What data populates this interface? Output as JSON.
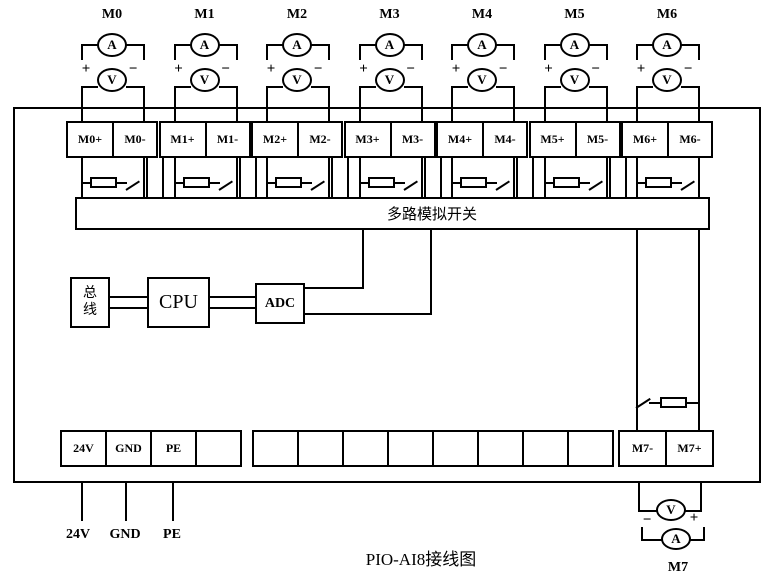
{
  "title": "PIO-AI8接线图",
  "mux_label": "多路模拟开关",
  "bus_label": "总线",
  "cpu_label": "CPU",
  "adc_label": "ADC",
  "meters": {
    "ammeter": "A",
    "voltmeter": "V",
    "plus": "+",
    "minus": "−"
  },
  "channels": [
    {
      "label": "M0",
      "plus_terminal": "M0+",
      "minus_terminal": "M0-"
    },
    {
      "label": "M1",
      "plus_terminal": "M1+",
      "minus_terminal": "M1-"
    },
    {
      "label": "M2",
      "plus_terminal": "M2+",
      "minus_terminal": "M2-"
    },
    {
      "label": "M3",
      "plus_terminal": "M3+",
      "minus_terminal": "M3-"
    },
    {
      "label": "M4",
      "plus_terminal": "M4+",
      "minus_terminal": "M4-"
    },
    {
      "label": "M5",
      "plus_terminal": "M5+",
      "minus_terminal": "M5-"
    },
    {
      "label": "M6",
      "plus_terminal": "M6+",
      "minus_terminal": "M6-"
    }
  ],
  "channel7": {
    "label": "M7",
    "minus_terminal": "M7-",
    "plus_terminal": "M7+"
  },
  "power_terminals": [
    "24V",
    "GND",
    "PE",
    ""
  ],
  "spare_terminals": [
    "",
    "",
    "",
    "",
    "",
    "",
    "",
    ""
  ],
  "power_wire_labels": [
    "24V",
    "GND",
    "PE"
  ],
  "colors": {
    "line": "#000000",
    "background": "#ffffff"
  }
}
